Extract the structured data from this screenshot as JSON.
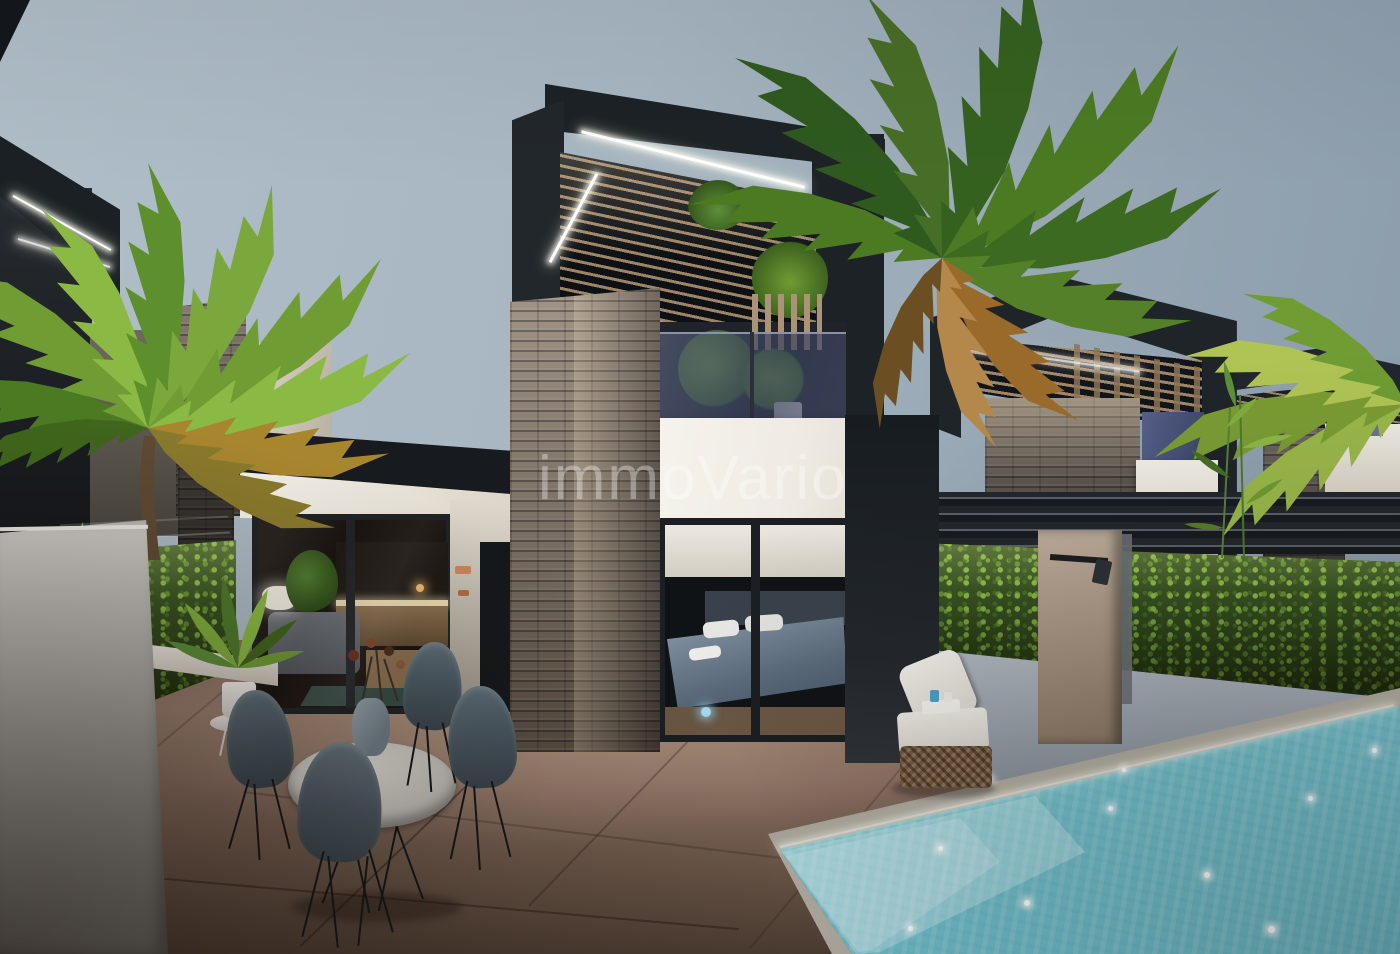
{
  "watermark": {
    "text": "immoVario"
  },
  "scene": {
    "type": "architectural-render",
    "setting": "dusk exterior of modern terraced villas with private pool",
    "objects": [
      "sky",
      "main-villa-pergola",
      "led-strip-lighting",
      "wood-slat-canopy",
      "stone-clad-columns",
      "upper-balcony-glass",
      "bedroom-sliding-window",
      "living-room-sliding-doors",
      "white-fascia",
      "neighbor-villa-2",
      "neighbor-villa-3",
      "green-hedge-walls",
      "boundary-wall",
      "outdoor-shower-panel",
      "swimming-pool",
      "pool-steps",
      "sun-lounger",
      "dining-table",
      "dining-chairs",
      "flower-vase",
      "potted-plant",
      "palm-trees",
      "terrace-tiles"
    ]
  },
  "palette": {
    "sky_left": "#aebcc6",
    "sky_right": "#8e9fae",
    "structure_dark": "#1e2428",
    "stone_light": "#8a7a6a",
    "stone_dark": "#4c433b",
    "wall_white": "#f3f0e9",
    "hedge_green": "#6f9c33",
    "pool_water": "#8fd2dc",
    "terrace_tile": "#8d7668",
    "wood_slat": "#a89070",
    "chair_gray": "#52626c",
    "watermark_color": "rgba(255,255,255,0.34)"
  }
}
